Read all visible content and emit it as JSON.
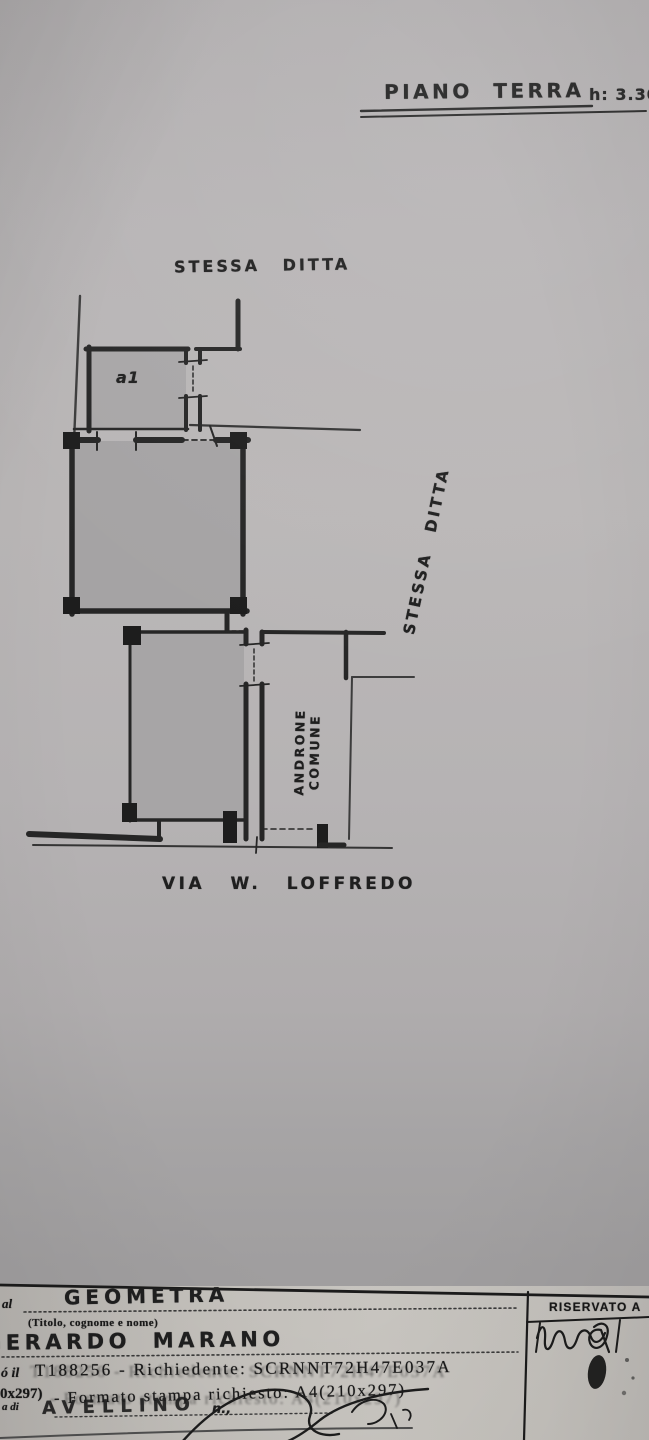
{
  "page": {
    "title": "PIANO TERRA",
    "height_note": "h: 3.30"
  },
  "plan": {
    "label_top": "STESSA DITTA",
    "label_right": "STESSA DITTA",
    "room_small_label": "a1",
    "corridor_label": [
      "ANDRONE",
      "COMUNE"
    ],
    "street_label": "VIA W. LOFFREDO"
  },
  "form": {
    "left_fragment": "al",
    "profession": "GEOMETRA",
    "profession_hint": "(Titolo, cognome e nome)",
    "name": "GERARDO MARANO",
    "row4_prefix": "ó il",
    "row4_text": "T188256 - Richiedente: SCRNNT72H47E037A",
    "row5_prefix": "0x297)",
    "row5_text": "- Formato stampa richiesto: A4(210x297)",
    "row5_left_fragment": "a di",
    "city_handwritten": "AVELLINO",
    "n_fragment": "n.,",
    "reserved_label": "RISERVATO A"
  },
  "colors": {
    "ink": "#1f1f1f",
    "wall": "#262626",
    "room_fill": "#a6a4a5",
    "paper_plan": "#b6b3b4",
    "paper_form": "#c6c3bf"
  }
}
